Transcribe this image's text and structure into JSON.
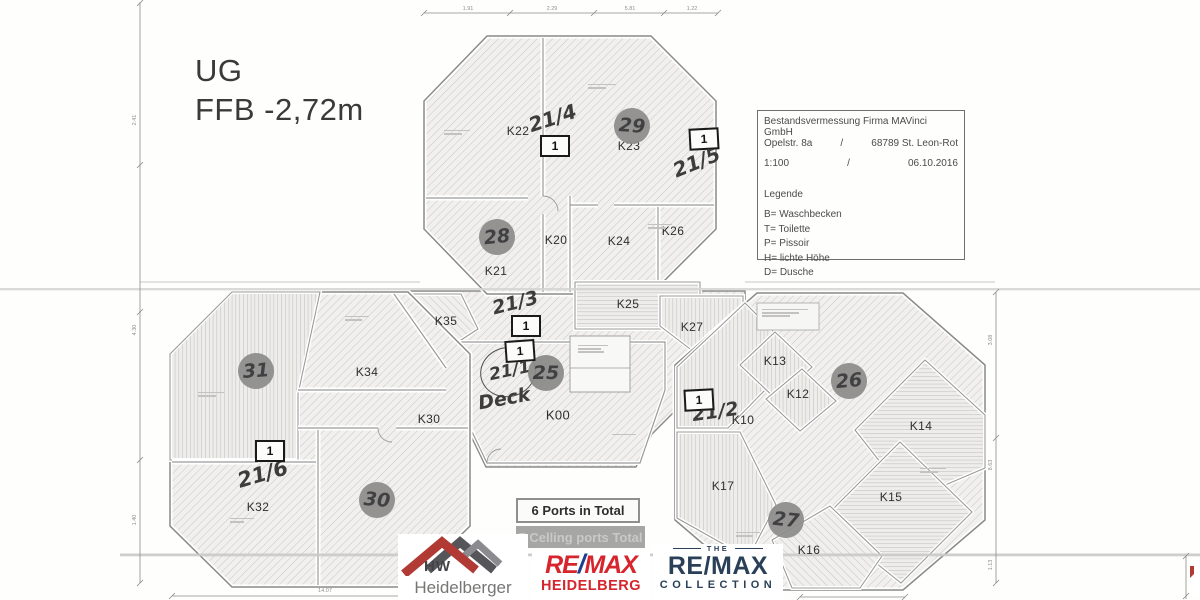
{
  "plan": {
    "title_line1": "UG",
    "title_line2": "FFB -2,72m"
  },
  "title_block": {
    "line1": "Bestandsvermessung Firma MAVinci GmbH",
    "addr_left": "Opelstr. 8a",
    "addr_slash": "/",
    "addr_right": "68789  St. Leon-Rot",
    "scale": "1:100",
    "scale_slash": "/",
    "date": "06.10.2016",
    "legend_title": "Legende",
    "legend": [
      "B= Waschbecken",
      "T= Toilette",
      "P= Pissoir",
      "H= lichte Höhe",
      "D= Dusche"
    ]
  },
  "rooms": {
    "k00": "K00",
    "k10": "K10",
    "k12": "K12",
    "k13": "K13",
    "k14": "K14",
    "k15": "K15",
    "k16": "K16",
    "k17": "K17",
    "k20": "K20",
    "k21": "K21",
    "k22": "K22",
    "k23": "K23",
    "k24": "K24",
    "k25": "K25",
    "k26": "K26",
    "k27": "K27",
    "k30": "K30",
    "k32": "K32",
    "k34": "K34",
    "k35": "K35"
  },
  "ports": {
    "marker": "1",
    "circles": {
      "c25": "25",
      "c26": "26",
      "c27": "27",
      "c28": "28",
      "c29": "29",
      "c30": "30",
      "c31": "31"
    },
    "total_ports": "6 Ports in Total",
    "total_ceiling": "7 Celling ports Total"
  },
  "handwriting": {
    "h1": "21/1",
    "deck": "Deck",
    "h2": "21/2",
    "h3": "21/3",
    "h4": "21/4",
    "h5": "21/5",
    "h6": "21/6"
  },
  "dims": {
    "top": [
      "1.91",
      "2.29",
      "5.81",
      "1.22"
    ],
    "left": [
      "2.41",
      "4.30",
      "1.40"
    ],
    "right": [
      "3.08",
      "8.63",
      "1.13"
    ],
    "bottom": [
      "14.07"
    ]
  },
  "logos": {
    "hw": {
      "initials": "HW",
      "name": "Heidelberger"
    },
    "remax": {
      "re": "RE",
      "slash": "/",
      "max": "MAX",
      "city": "HEIDELBERG"
    },
    "collection": {
      "the": "THE",
      "brand": "RE/MAX",
      "name": "COLLECTION"
    }
  },
  "colors": {
    "remax_red": "#d6252c",
    "remax_blue": "#1c3e8e",
    "collection_navy": "#2a4058",
    "port_circle_gray": "#8d8d8c",
    "hatch_line": "#c7c6c3"
  }
}
